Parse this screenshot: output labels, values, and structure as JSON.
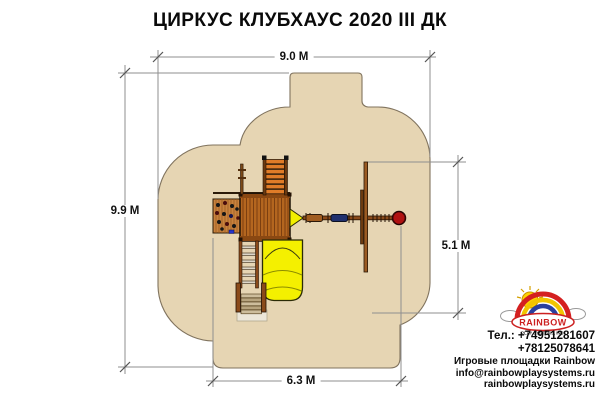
{
  "title": "ЦИРКУС КЛУБХАУС 2020 III ДК",
  "dimensions": {
    "top": "9.0 M",
    "left": "9.9 M",
    "right": "5.1 M",
    "bottom": "6.3 M"
  },
  "contact": {
    "phone1": "Тел.: +74951281607",
    "phone2": "+78125078641",
    "brand_line": "Игровые площадки Rainbow",
    "email": "info@rainbowplaysystems.ru",
    "website": "rainbowplaysystems.ru"
  },
  "logo": {
    "brand": "RAINBOW",
    "subtitle": "PLAY SYSTEMS, INC."
  },
  "colors": {
    "safety_zone_fill": "#e6d5b3",
    "safety_zone_stroke": "#80735e",
    "deck_wood": "#b4661f",
    "ramp_orange": "#e07c28",
    "slide_yellow": "#f4f000",
    "ball_red": "#b01212",
    "seat_blue": "#20306e",
    "dimension_line": "#8f8f8f"
  },
  "equipment": {
    "items": [
      "climbing-wall",
      "clubhouse-deck",
      "access-ramp",
      "flag-pole",
      "entry-ladder",
      "stairs",
      "tube-slide",
      "swing-beam",
      "swing-seat",
      "swing-seat-blue",
      "swing-frame-post",
      "ball-swing"
    ]
  }
}
